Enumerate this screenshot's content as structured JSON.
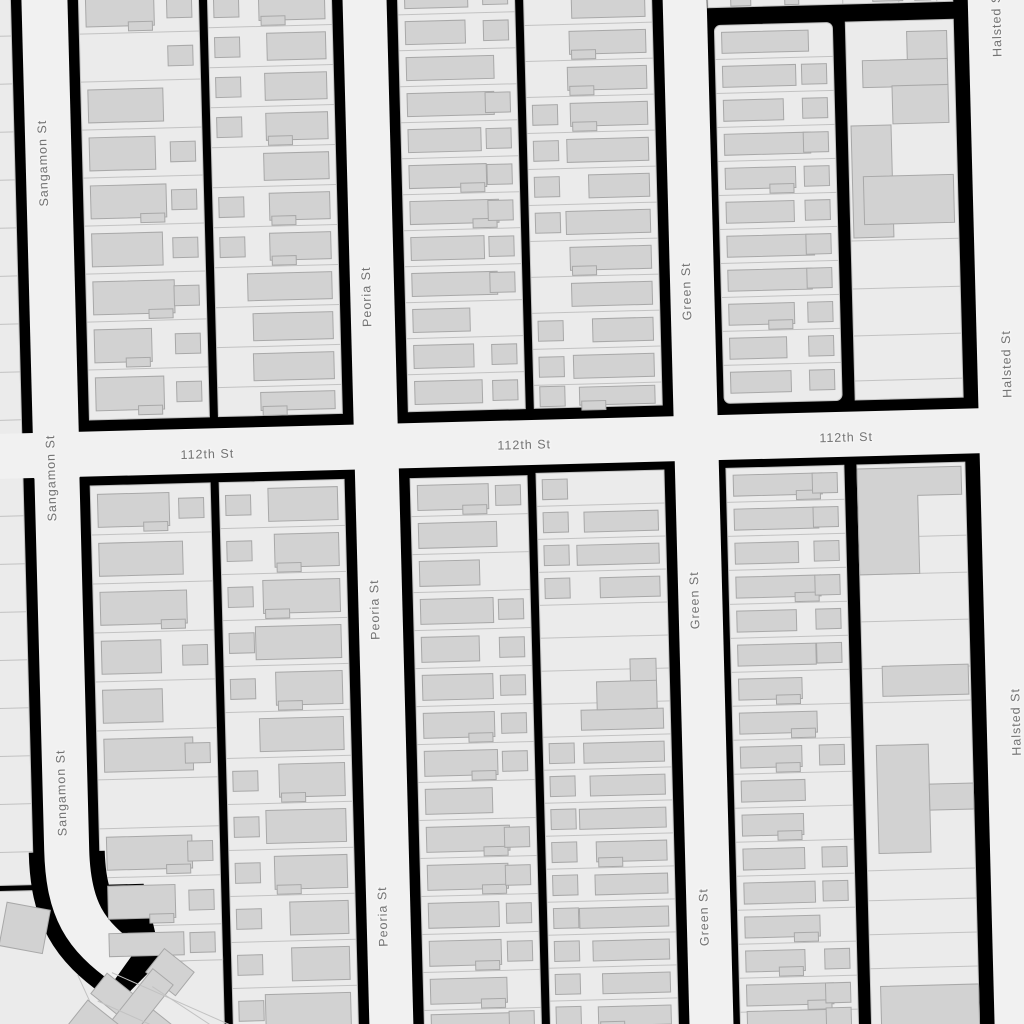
{
  "map": {
    "canvas": {
      "width": 1024,
      "height": 1024,
      "rotation_deg": -1.5,
      "rotation_center_x": 512,
      "rotation_center_y": 512
    },
    "colors": {
      "background": "#000000",
      "road": "#f1f1f1",
      "lot": "#ebebeb",
      "lot_line": "#c2c2c2",
      "building": "#d2d2d2",
      "building_stroke": "#a8a8a8",
      "label_text": "#737373",
      "label_halo": "#f4f4f4"
    },
    "seed": 13,
    "streets": [
      {
        "id": "sangamon",
        "name": "Sangamon St",
        "type": "v",
        "x": 58,
        "w": 46,
        "y1": -30,
        "y2": 466
      },
      {
        "id": "sangamon-south",
        "name": "Sangamon St",
        "type": "curve",
        "path": "M 58 430 L 58 838 C 58 898 74 924 114 954",
        "w": 45
      },
      {
        "id": "peoria",
        "name": "Peoria St",
        "type": "v",
        "x": 378,
        "w": 44,
        "y1": -30,
        "y2": 1054
      },
      {
        "id": "green",
        "name": "Green St",
        "type": "v",
        "x": 698,
        "w": 44,
        "y1": -30,
        "y2": 1054
      },
      {
        "id": "halsted",
        "name": "Halsted St",
        "type": "v",
        "x": 1010,
        "w": 58,
        "y1": -30,
        "y2": 1054
      },
      {
        "id": "112th",
        "name": "112th St",
        "type": "h",
        "y": 443,
        "h": 45,
        "x1": -30,
        "x2": 1054
      }
    ],
    "labels": [
      {
        "text": "Sangamon St",
        "x": 53,
        "y": 151,
        "rotate": -90
      },
      {
        "text": "Sangamon St",
        "x": 53,
        "y": 466,
        "rotate": -90
      },
      {
        "text": "Sangamon St",
        "x": 55,
        "y": 781,
        "rotate": -90
      },
      {
        "text": "Peoria St",
        "x": 373,
        "y": 293,
        "rotate": -90
      },
      {
        "text": "Peoria St",
        "x": 373,
        "y": 606,
        "rotate": -90
      },
      {
        "text": "Peoria St",
        "x": 373,
        "y": 913,
        "rotate": -90
      },
      {
        "text": "Green St",
        "x": 693,
        "y": 296,
        "rotate": -90
      },
      {
        "text": "Green St",
        "x": 693,
        "y": 605,
        "rotate": -90
      },
      {
        "text": "Green St",
        "x": 694,
        "y": 922,
        "rotate": -90
      },
      {
        "text": "Halsted St",
        "x": 1010,
        "y": 36,
        "rotate": -90
      },
      {
        "text": "Halsted St",
        "x": 1011,
        "y": 377,
        "rotate": -90
      },
      {
        "text": "Halsted St",
        "x": 1011,
        "y": 735,
        "rotate": -90
      },
      {
        "text": "112th St",
        "x": 209,
        "y": 447,
        "rotate": 0
      },
      {
        "text": "112th St",
        "x": 526,
        "y": 446,
        "rotate": 0
      },
      {
        "text": "112th St",
        "x": 848,
        "y": 447,
        "rotate": 0
      }
    ],
    "lot_areas": [
      {
        "id": "west-sliver",
        "x": -25,
        "w": 49,
        "y0": -25,
        "y1": 872,
        "row_h": 48
      },
      {
        "id": "topright-sliver",
        "x": 721,
        "w": 245,
        "y0": -25,
        "y1": 13,
        "vlines": [
          754,
          802,
          856,
          912,
          950
        ]
      }
    ],
    "columns": [
      {
        "id": "b1-west",
        "x": 92,
        "w": 120,
        "y0": -25,
        "y1": 409,
        "row_h": 48,
        "side": "left"
      },
      {
        "id": "b1-east",
        "x": 221,
        "w": 124,
        "y0": -20,
        "y1": 409,
        "row_h": 40,
        "side": "right"
      },
      {
        "id": "b2-west",
        "x": 411,
        "w": 117,
        "y0": -24,
        "y1": 409,
        "row_h": 36,
        "side": "left"
      },
      {
        "id": "b2-east",
        "x": 537,
        "w": 128,
        "y0": -10,
        "y1": 409,
        "row_h": 36,
        "side": "right"
      },
      {
        "id": "b3-west",
        "x": 727,
        "w": 118,
        "y0": 31,
        "y1": 409,
        "row_h": 34,
        "side": "left",
        "rx": 6
      },
      {
        "id": "b3-east-commercial",
        "x": 858,
        "w": 108,
        "y0": 31,
        "y1": 409,
        "lines": [
          250,
          298,
          345,
          390
        ]
      },
      {
        "id": "b4-west",
        "x": 91,
        "w": 120,
        "y0": 475,
        "y1": 952,
        "row_h": 49,
        "side": "left"
      },
      {
        "id": "b4-east",
        "x": 220,
        "w": 125,
        "y0": 475,
        "y1": 1034,
        "row_h": 46,
        "side": "right"
      },
      {
        "id": "b5-west",
        "x": 411,
        "w": 117,
        "y0": 476,
        "y1": 1034,
        "row_h": 38,
        "side": "left"
      },
      {
        "id": "b5-east",
        "x": 537,
        "w": 128,
        "y0": 474,
        "y1": 1034,
        "row_h": 33,
        "side": "right",
        "skip": [
          4,
          5,
          6
        ]
      },
      {
        "id": "b6-west",
        "x": 727,
        "w": 118,
        "y0": 474,
        "y1": 1034,
        "row_h": 34,
        "side": "left"
      },
      {
        "id": "b6-east-commercial",
        "x": 858,
        "w": 108,
        "y0": 474,
        "y1": 1034,
        "lines": [
          547,
          584,
          631,
          678,
          712,
          880,
          910,
          944,
          978
        ]
      }
    ],
    "special_buildings": [
      {
        "x": 919,
        "y": 42,
        "w": 40,
        "h": 30
      },
      {
        "x": 874,
        "y": 70,
        "w": 85,
        "h": 27
      },
      {
        "x": 903,
        "y": 96,
        "w": 56,
        "h": 38
      },
      {
        "x": 861,
        "y": 135,
        "w": 40,
        "h": 112
      },
      {
        "x": 872,
        "y": 186,
        "w": 90,
        "h": 48
      },
      {
        "x": 744,
        "y": -6,
        "w": 20,
        "h": 18
      },
      {
        "x": 798,
        "y": -8,
        "w": 14,
        "h": 20
      },
      {
        "x": 886,
        "y": -4,
        "w": 30,
        "h": 15
      },
      {
        "x": 928,
        "y": -2,
        "w": 16,
        "h": 13
      },
      {
        "pts": "858,478 962,478 962,506 918,506 918,584 858,584"
      },
      {
        "x": 878,
        "y": 676,
        "w": 86,
        "h": 30
      },
      {
        "x": 870,
        "y": 755,
        "w": 52,
        "h": 108
      },
      {
        "x": 922,
        "y": 795,
        "w": 44,
        "h": 26
      },
      {
        "x": 868,
        "y": 996,
        "w": 98,
        "h": 42
      },
      {
        "x": 626,
        "y": 662,
        "w": 26,
        "h": 50
      },
      {
        "x": 592,
        "y": 684,
        "w": 60,
        "h": 28
      },
      {
        "x": -8,
        "y": 893,
        "w": 44,
        "h": 44,
        "rotate": 12
      },
      {
        "x": 139,
        "y": 948,
        "w": 38,
        "h": 30,
        "rotate": 40
      },
      {
        "x": 76,
        "y": 989,
        "w": 92,
        "h": 26,
        "rotate": 40
      },
      {
        "x": 109,
        "y": 957,
        "w": 26,
        "h": 90,
        "rotate": 40
      },
      {
        "x": 58,
        "y": 1000,
        "w": 48,
        "h": 36,
        "rotate": 40
      }
    ],
    "fan": {
      "light_polygons": [
        "-30,878 32,878 32,902 150,998 96,1044 -30,1044",
        "66,964 211,948 211,1044 100,1044"
      ],
      "black_polygon": "80,874 134,874 150,950 100,998 70,930",
      "casing_path": "M 58 840 C 58 898 74 924 114 954",
      "casing_width": 76,
      "lines": [
        [
          100,
          962,
          252,
          1034
        ],
        [
          85,
          990,
          198,
          1044
        ],
        [
          140,
          977,
          216,
          1030
        ]
      ]
    }
  }
}
